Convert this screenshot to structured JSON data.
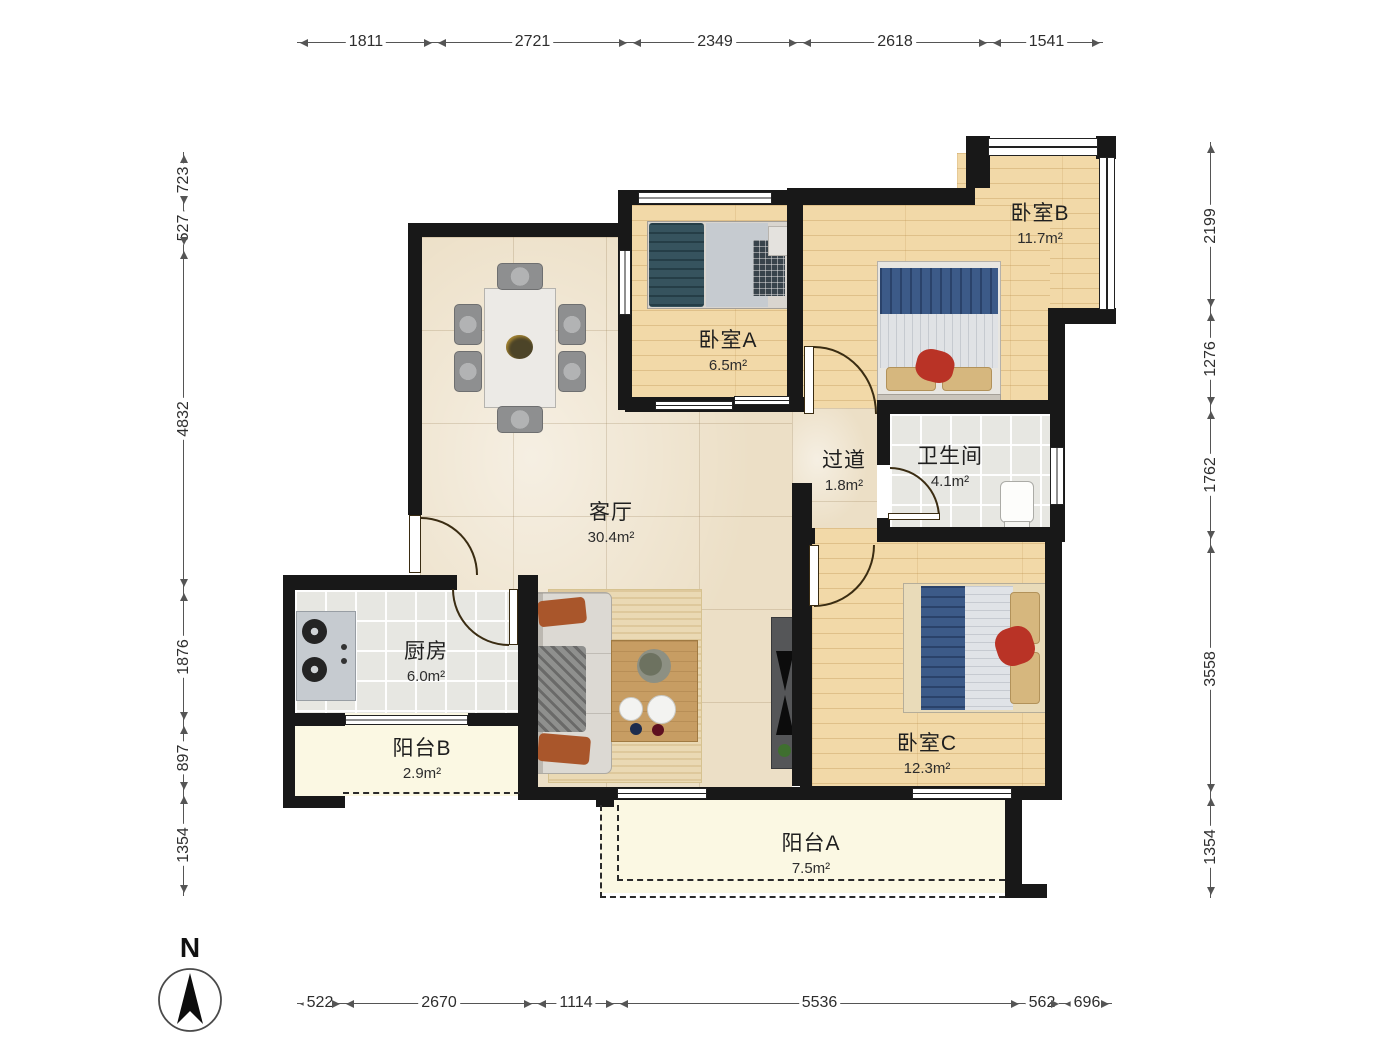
{
  "compass": {
    "label": "N"
  },
  "rooms": {
    "bedroomB": {
      "name": "卧室B",
      "area": "11.7m²"
    },
    "bedroomA": {
      "name": "卧室A",
      "area": "6.5m²"
    },
    "hallway": {
      "name": "过道",
      "area": "1.8m²"
    },
    "bathroom": {
      "name": "卫生间",
      "area": "4.1m²"
    },
    "living": {
      "name": "客厅",
      "area": "30.4m²"
    },
    "kitchen": {
      "name": "厨房",
      "area": "6.0m²"
    },
    "balconyB": {
      "name": "阳台B",
      "area": "2.9m²"
    },
    "bedroomC": {
      "name": "卧室C",
      "area": "12.3m²"
    },
    "balconyA": {
      "name": "阳台A",
      "area": "7.5m²"
    }
  },
  "dimensions": {
    "top": [
      "1811",
      "2721",
      "2349",
      "2618",
      "1541"
    ],
    "left": [
      "723",
      "527",
      "4832",
      "1876",
      "897",
      "1354"
    ],
    "right": [
      "2199",
      "1276",
      "1762",
      "3558",
      "1354"
    ],
    "bottom": [
      "522",
      "2670",
      "1114",
      "5536",
      "562",
      "696"
    ]
  }
}
